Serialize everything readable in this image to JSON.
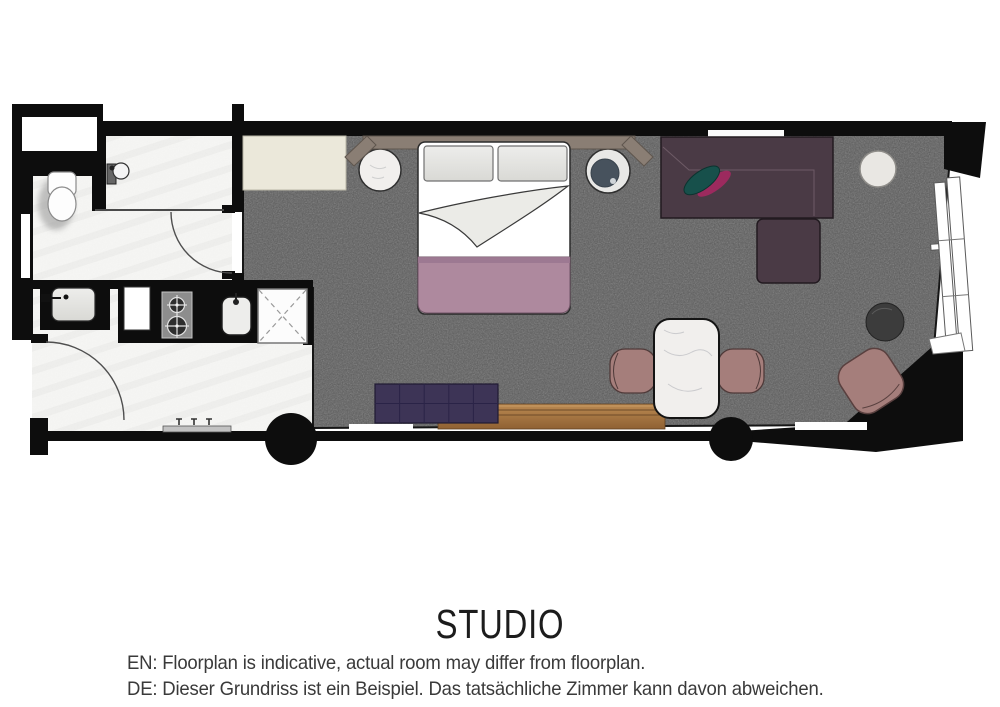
{
  "title": "STUDIO",
  "notes": {
    "en": "EN: Floorplan is indicative, actual room may differ from floorplan.",
    "de": "DE: Dieser Grundriss ist ein Beispiel. Das tatsächliche Zimmer kann davon abweichen."
  },
  "theme": {
    "wall": "#0d0d0d",
    "carpet": "#5a5a5a",
    "tile": "#f6f6f4",
    "wood-light": "#bb8a52",
    "wood-dark": "#8f6133",
    "blanket": "#ae899e",
    "sofa": "#4a3a45",
    "bench": "#3d3456",
    "chair": "#a57e7b",
    "cream": "#ebe8da",
    "headboard": "#8a7e74",
    "marble": "#f1efed",
    "stool-cushion": "#47525d",
    "cushion-teal": "#17504b",
    "cushion-magenta": "#9c2a5e",
    "text": "#3a3a3a"
  },
  "elements": [
    "bathroom",
    "toilet",
    "wall-basin",
    "vanity-sink",
    "entry-door",
    "bathroom-door",
    "wardrobe",
    "fridge",
    "stove",
    "kitchen-sink",
    "shower",
    "column",
    "bed",
    "pillows",
    "headboard",
    "nightstand",
    "stool",
    "sofa",
    "cushion",
    "side-table",
    "dining-table",
    "dining-chair",
    "ottoman",
    "lounge-chair",
    "bench-ottoman",
    "media-console",
    "window",
    "radiator"
  ]
}
